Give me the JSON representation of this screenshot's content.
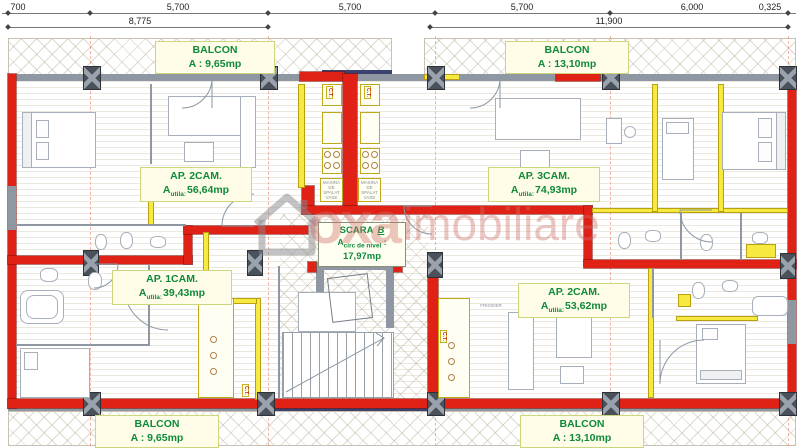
{
  "dimensions": {
    "row1": [
      "700",
      "5,700",
      "5,700",
      "5,700",
      "6,000",
      "0,325"
    ],
    "row2": [
      "8,775",
      "11,900"
    ]
  },
  "labels": {
    "balcon_tl": {
      "name": "BALCON",
      "area": "A : 9,65mp"
    },
    "balcon_tr": {
      "name": "BALCON",
      "area": "A : 13,10mp"
    },
    "balcon_bl": {
      "name": "BALCON",
      "area": "A : 9,65mp"
    },
    "balcon_br": {
      "name": "BALCON",
      "area": "A : 13,10mp"
    },
    "ap2_top": {
      "name": "AP. 2CAM.",
      "a": "A",
      "sub": "utila:",
      "val": "56,64mp"
    },
    "ap3": {
      "name": "AP. 3CAM.",
      "a": "A",
      "sub": "utila:",
      "val": "74,93mp"
    },
    "ap1": {
      "name": "AP. 1CAM.",
      "a": "A",
      "sub": "utila:",
      "val": "39,43mp"
    },
    "ap2_bottom": {
      "name": "AP. 2CAM.",
      "a": "A",
      "sub": "utila:",
      "val": "53,62mp"
    },
    "scara": {
      "name": "SCARA",
      "suffix": "B",
      "a": "A",
      "sub": "circ de nivel",
      "colon": ":",
      "val": "17,97mp"
    }
  },
  "equipment": {
    "ct": "C.T.",
    "frigider": "FRIGIDER",
    "masina_spalat": "MASINA DE SPALAT VASE"
  },
  "watermark": {
    "left": "oxa",
    "right": "imobiliare"
  },
  "colors": {
    "wall_red": "#e02116",
    "accent_yellow": "#f6e93f",
    "label_green": "#0e8a3a",
    "window_gray": "#a8aeb6",
    "column_dark": "#4b515b",
    "watermark_red": "#cc6e66"
  }
}
